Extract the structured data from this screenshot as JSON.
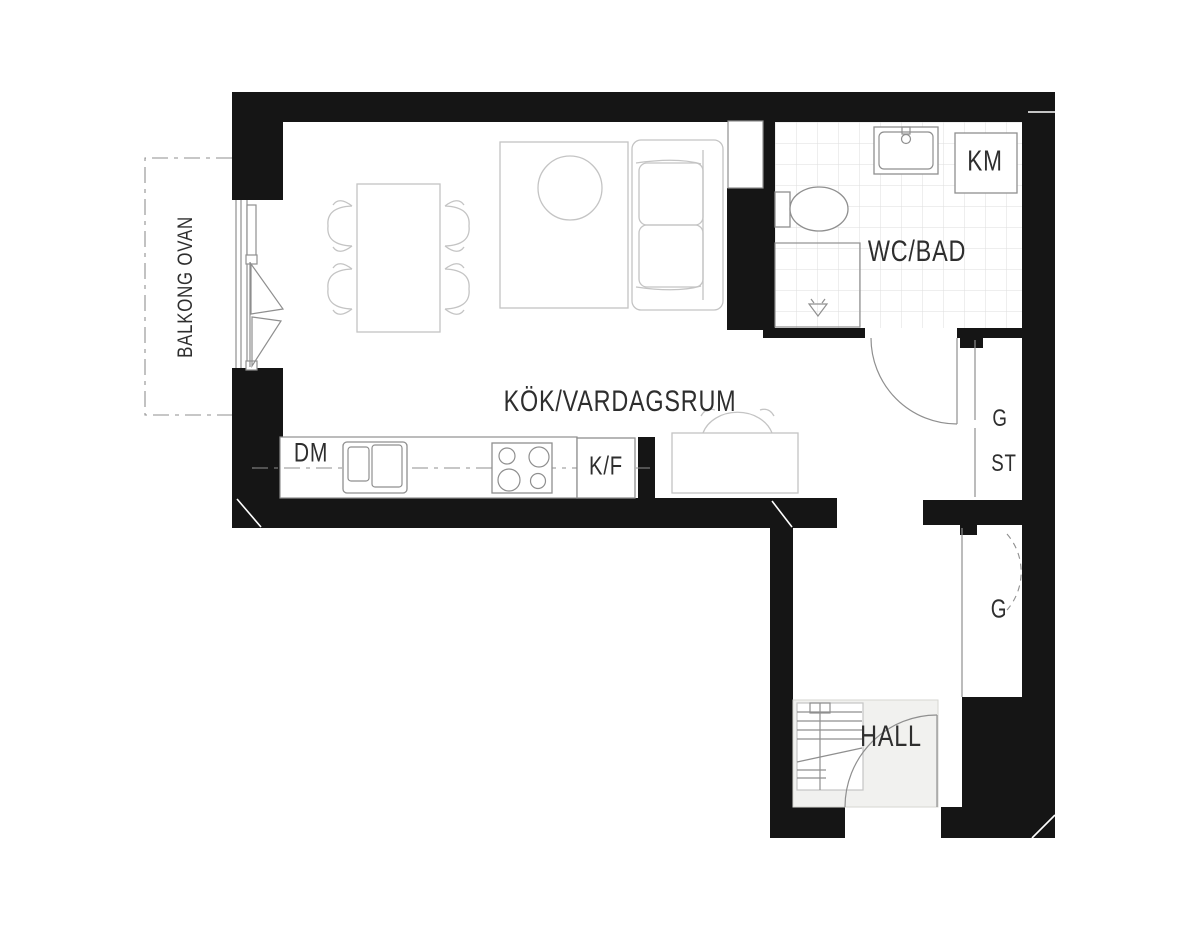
{
  "theme": {
    "background": "#ffffff",
    "wall_color": "#151515",
    "line_color": "#8f8f8f",
    "furniture_line_color": "#c4c4c4",
    "tile_line_color": "#dedede",
    "hall_floor_color": "#f1f1ef",
    "label_color": "#2e2e2e"
  },
  "labels": {
    "balcony": "BALKONG OVAN",
    "kitchen_living": "KÖK/VARDAGSRUM",
    "bathroom": "WC/BAD",
    "washing_machine": "KM",
    "dishwasher": "DM",
    "fridge_freezer": "K/F",
    "wardrobe_upper": "G",
    "cleaning_cabinet": "ST",
    "wardrobe_hall": "G",
    "hall": "HALL"
  }
}
